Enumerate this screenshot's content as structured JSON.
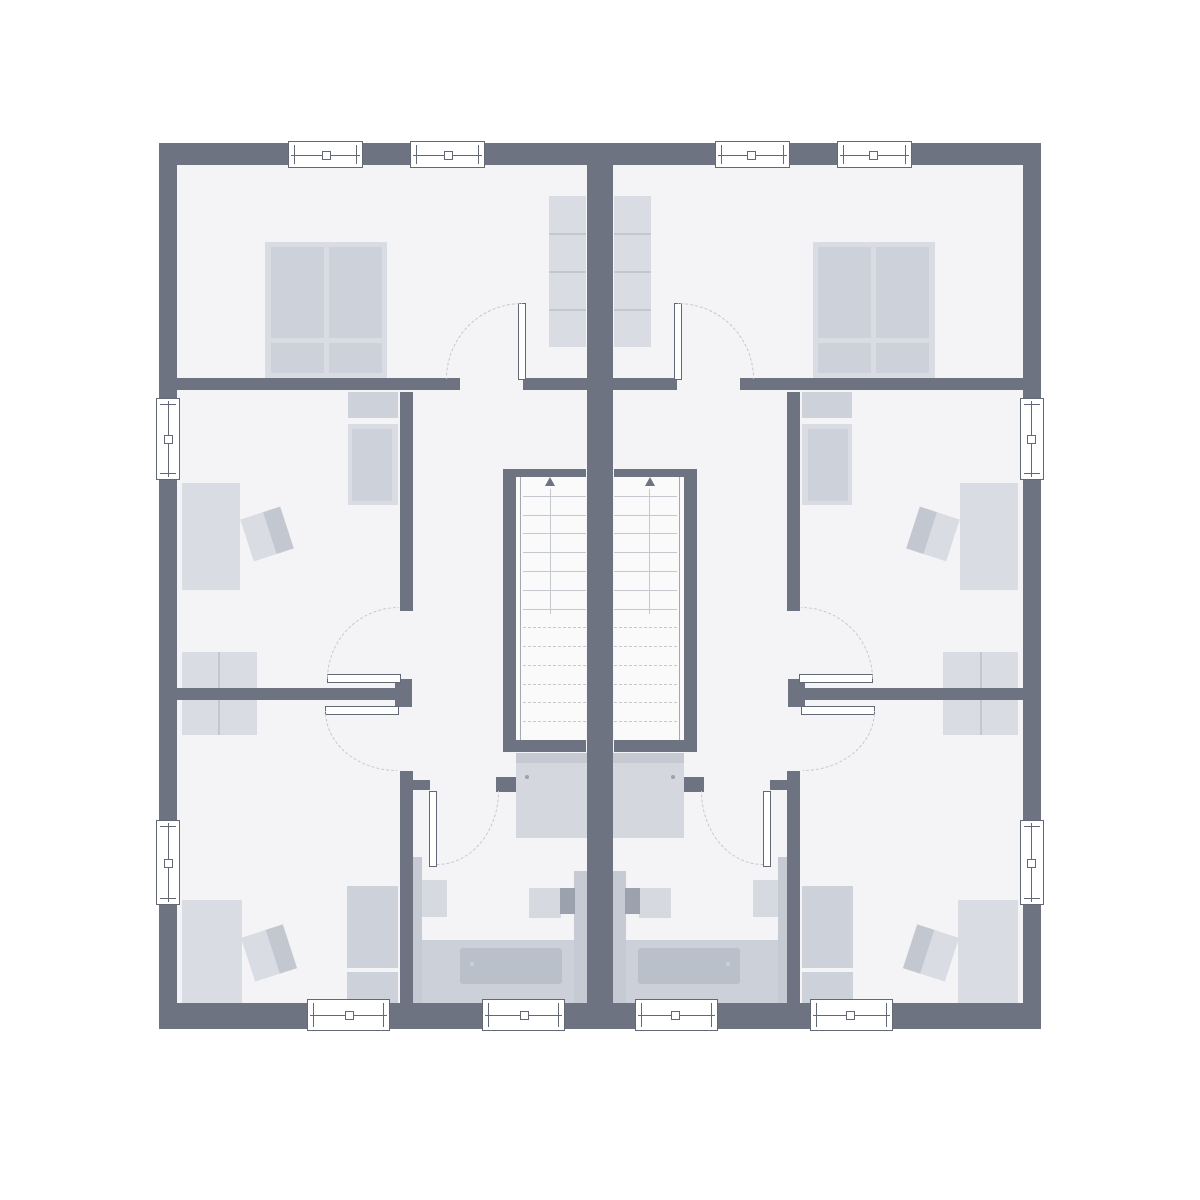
{
  "meta": {
    "title": "duplex-upper-floor-plan",
    "canvas_w": 1200,
    "canvas_h": 1200,
    "units": 2,
    "mirror_axis_x": 600
  },
  "palette": {
    "wall": "#6d7380",
    "floor": "#f4f4f7",
    "stairFloor": "#fafafb",
    "furnLight": "#d9dce2",
    "furnMid": "#cdd1d9",
    "furnDark": "#c3c7d0",
    "fixture": "#d6d9df",
    "pilaster": "#9ba1ad",
    "strip": "#c6cad3",
    "platform": "#ccd0d8",
    "tub": "#bac0ca",
    "shower": "#d4d7dd",
    "showerEdge": "#c6c9d1",
    "line": "#c6c8d0",
    "rail": "#a3a8b3",
    "arc": "#c3c6ce",
    "frame": "#626876"
  },
  "shared_floor": [
    {
      "t": "rect",
      "name": "floor",
      "x": 177,
      "y": 165,
      "w": 846,
      "h": 838,
      "fill": "floor"
    }
  ],
  "walls_shared": [
    {
      "t": "rect",
      "name": "wall-exterior-top",
      "x": 159,
      "y": 143,
      "w": 882,
      "h": 22,
      "fill": "wall"
    },
    {
      "t": "rect",
      "name": "wall-exterior-bottom",
      "x": 159,
      "y": 1003,
      "w": 882,
      "h": 26,
      "fill": "wall"
    },
    {
      "t": "rect",
      "name": "wall-exterior-left",
      "x": 159,
      "y": 143,
      "w": 18,
      "h": 886,
      "fill": "wall"
    },
    {
      "t": "rect",
      "name": "wall-exterior-right",
      "x": 1023,
      "y": 143,
      "w": 18,
      "h": 886,
      "fill": "wall"
    },
    {
      "t": "rect",
      "name": "wall-party",
      "x": 587,
      "y": 143,
      "w": 26,
      "h": 886,
      "fill": "wall"
    }
  ],
  "unit": {
    "under": [
      {
        "t": "rect",
        "name": "double-bed-frame",
        "x": 265,
        "y": 242,
        "w": 122,
        "h": 136,
        "fill": "furnLight"
      },
      {
        "t": "rect",
        "name": "bed-mattress-left",
        "x": 271,
        "y": 247,
        "w": 53,
        "h": 91,
        "fill": "furnMid"
      },
      {
        "t": "rect",
        "name": "bed-mattress-right",
        "x": 329,
        "y": 247,
        "w": 53,
        "h": 91,
        "fill": "furnMid"
      },
      {
        "t": "rect",
        "name": "bed-pillow-left",
        "x": 271,
        "y": 343,
        "w": 53,
        "h": 30,
        "fill": "furnMid"
      },
      {
        "t": "rect",
        "name": "bed-pillow-right",
        "x": 329,
        "y": 343,
        "w": 53,
        "h": 30,
        "fill": "furnMid"
      },
      {
        "t": "rect",
        "name": "bedroom-wardrobe",
        "x": 549,
        "y": 196,
        "w": 37,
        "h": 151,
        "fill": "furnLight"
      },
      {
        "t": "rect",
        "name": "bedroom-wardrobe-divider",
        "x": 549,
        "y": 233,
        "w": 37,
        "h": 2,
        "fill": "furnDark"
      },
      {
        "t": "rect",
        "name": "bedroom-wardrobe-divider",
        "x": 549,
        "y": 271,
        "w": 37,
        "h": 2,
        "fill": "furnDark"
      },
      {
        "t": "rect",
        "name": "bedroom-wardrobe-divider",
        "x": 549,
        "y": 309,
        "w": 37,
        "h": 2,
        "fill": "furnDark"
      },
      {
        "t": "rect",
        "name": "midroom-wardrobe-top",
        "x": 348,
        "y": 392,
        "w": 50,
        "h": 26,
        "fill": "furnMid"
      },
      {
        "t": "rect",
        "name": "midroom-wardrobe-body",
        "x": 348,
        "y": 424,
        "w": 50,
        "h": 81,
        "fill": "furnLight"
      },
      {
        "t": "rect",
        "name": "midroom-wardrobe-inner",
        "x": 352,
        "y": 429,
        "w": 40,
        "h": 72,
        "fill": "furnMid"
      },
      {
        "t": "rect",
        "name": "midroom-desk",
        "x": 182,
        "y": 483,
        "w": 58,
        "h": 107,
        "fill": "furnLight"
      },
      {
        "t": "chair",
        "name": "midroom-chair",
        "x": 246,
        "y": 512,
        "w": 42,
        "h": 44,
        "rot": -18
      },
      {
        "t": "rect",
        "name": "sideboard",
        "x": 182,
        "y": 652,
        "w": 75,
        "h": 83,
        "fill": "furnLight"
      },
      {
        "t": "rect",
        "name": "sideboard-divider",
        "x": 218,
        "y": 652,
        "w": 2,
        "h": 83,
        "fill": "furnDark"
      },
      {
        "t": "rect",
        "name": "bottomroom-desk",
        "x": 182,
        "y": 900,
        "w": 60,
        "h": 103,
        "fill": "furnLight"
      },
      {
        "t": "chair",
        "name": "bottomroom-chair",
        "x": 247,
        "y": 930,
        "w": 44,
        "h": 46,
        "rot": -18
      },
      {
        "t": "rect",
        "name": "bottomroom-wardrobe-upper",
        "x": 347,
        "y": 886,
        "w": 51,
        "h": 82,
        "fill": "furnMid"
      },
      {
        "t": "rect",
        "name": "bottomroom-wardrobe-lower",
        "x": 347,
        "y": 972,
        "w": 51,
        "h": 31,
        "fill": "furnMid"
      },
      {
        "t": "rect",
        "name": "shower-tray",
        "x": 516,
        "y": 753,
        "w": 71,
        "h": 85,
        "fill": "shower"
      },
      {
        "t": "rect",
        "name": "shower-edge",
        "x": 516,
        "y": 753,
        "w": 71,
        "h": 10,
        "fill": "showerEdge"
      },
      {
        "t": "rect",
        "name": "shower-drain",
        "x": 525,
        "y": 775,
        "w": 4,
        "h": 4,
        "fill": "pilaster",
        "r": 2
      },
      {
        "t": "rect",
        "name": "bath-wall-strip-left",
        "x": 413,
        "y": 857,
        "w": 9,
        "h": 146,
        "fill": "strip"
      },
      {
        "t": "rect",
        "name": "bath-wall-strip-right",
        "x": 574,
        "y": 871,
        "w": 13,
        "h": 132,
        "fill": "strip"
      },
      {
        "t": "rect",
        "name": "toilet",
        "x": 422,
        "y": 880,
        "w": 25,
        "h": 37,
        "fill": "fixture"
      },
      {
        "t": "rect",
        "name": "washbasin",
        "x": 529,
        "y": 888,
        "w": 32,
        "h": 30,
        "fill": "fixture"
      },
      {
        "t": "rect",
        "name": "washbasin-pilaster",
        "x": 560,
        "y": 888,
        "w": 15,
        "h": 26,
        "fill": "pilaster"
      },
      {
        "t": "rect",
        "name": "bathtub-platform",
        "x": 422,
        "y": 940,
        "w": 152,
        "h": 63,
        "fill": "platform"
      },
      {
        "t": "rect",
        "name": "bathtub",
        "x": 460,
        "y": 948,
        "w": 102,
        "h": 36,
        "fill": "tub",
        "r": 3
      },
      {
        "t": "rect",
        "name": "bathtub-drain",
        "x": 470,
        "y": 962,
        "w": 4,
        "h": 4,
        "fill": "platform",
        "r": 2
      }
    ],
    "walls": [
      {
        "t": "rect",
        "name": "bedroom-wall-left-segment",
        "x": 177,
        "y": 378,
        "w": 283,
        "h": 12,
        "fill": "wall"
      },
      {
        "t": "rect",
        "name": "bedroom-wall-right-segment",
        "x": 523,
        "y": 378,
        "w": 64,
        "h": 12,
        "fill": "wall"
      },
      {
        "t": "rect",
        "name": "corridor-wall",
        "x": 400,
        "y": 392,
        "w": 13,
        "h": 219,
        "fill": "wall"
      },
      {
        "t": "rect",
        "name": "door-pillar",
        "x": 395,
        "y": 679,
        "w": 17,
        "h": 28,
        "fill": "wall"
      },
      {
        "t": "rect",
        "name": "room-divider-wall",
        "x": 177,
        "y": 688,
        "w": 218,
        "h": 12,
        "fill": "wall"
      },
      {
        "t": "rect",
        "name": "bathroom-wall",
        "x": 400,
        "y": 771,
        "w": 13,
        "h": 232,
        "fill": "wall"
      },
      {
        "t": "rect",
        "name": "bathroom-door-stub",
        "x": 400,
        "y": 780,
        "w": 30,
        "h": 10,
        "fill": "wall"
      },
      {
        "t": "rect",
        "name": "stairwell-wall-side",
        "x": 503,
        "y": 469,
        "w": 13,
        "h": 283,
        "fill": "wall"
      },
      {
        "t": "rect",
        "name": "stairwell-wall-top",
        "x": 503,
        "y": 469,
        "w": 83,
        "h": 8,
        "fill": "wall"
      },
      {
        "t": "rect",
        "name": "stairwell-wall-bottom",
        "x": 503,
        "y": 740,
        "w": 83,
        "h": 12,
        "fill": "wall"
      },
      {
        "t": "rect",
        "name": "bathroom-door-jamb",
        "x": 496,
        "y": 777,
        "w": 20,
        "h": 15,
        "fill": "wall"
      }
    ],
    "over": [
      {
        "t": "win",
        "name": "window-bedroom-1",
        "x": 288,
        "y": 141,
        "w": 75,
        "h": 27
      },
      {
        "t": "win",
        "name": "window-bedroom-2",
        "x": 410,
        "y": 141,
        "w": 75,
        "h": 27
      },
      {
        "t": "win",
        "name": "window-midroom-side",
        "x": 156,
        "y": 398,
        "w": 24,
        "h": 82
      },
      {
        "t": "win",
        "name": "window-bottomroom-side",
        "x": 156,
        "y": 820,
        "w": 24,
        "h": 85
      },
      {
        "t": "win",
        "name": "window-bottomroom",
        "x": 307,
        "y": 999,
        "w": 83,
        "h": 32
      },
      {
        "t": "win",
        "name": "window-bathroom",
        "x": 482,
        "y": 999,
        "w": 83,
        "h": 32
      },
      {
        "t": "leaf",
        "name": "bedroom-door-leaf",
        "x": 518,
        "y": 303,
        "w": 8,
        "h": 77
      },
      {
        "t": "arc",
        "name": "bedroom-door-swing",
        "x": 446,
        "y": 303,
        "w": 76,
        "h": 76,
        "corner": "tl"
      },
      {
        "t": "leaf",
        "name": "midroom-door-leaf",
        "x": 327,
        "y": 674,
        "w": 74,
        "h": 9
      },
      {
        "t": "arc",
        "name": "midroom-door-swing",
        "x": 327,
        "y": 607,
        "w": 72,
        "h": 72,
        "corner": "tl"
      },
      {
        "t": "leaf",
        "name": "bottomroom-door-leaf",
        "x": 325,
        "y": 706,
        "w": 74,
        "h": 9
      },
      {
        "t": "arc",
        "name": "bottomroom-door-swing",
        "x": 325,
        "y": 711,
        "w": 72,
        "h": 60,
        "corner": "bl"
      },
      {
        "t": "leaf",
        "name": "bathroom-door-leaf",
        "x": 429,
        "y": 791,
        "w": 8,
        "h": 76
      },
      {
        "t": "arc",
        "name": "bathroom-door-swing",
        "x": 437,
        "y": 791,
        "w": 62,
        "h": 74,
        "corner": "br"
      },
      {
        "t": "stairs",
        "name": "staircase",
        "x": 516,
        "y": 477,
        "w": 70,
        "h": 263,
        "treads": 13,
        "solid": 7
      }
    ]
  }
}
